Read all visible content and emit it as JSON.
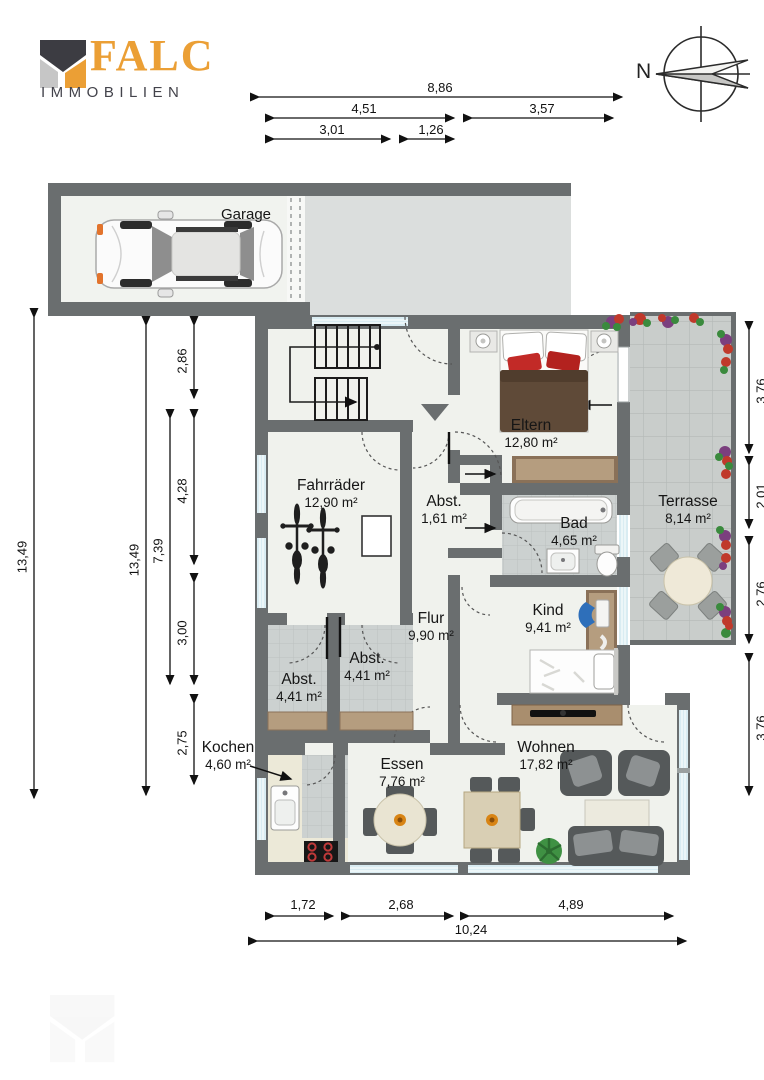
{
  "brand": {
    "name": "FALC",
    "sub": "IMMOBILIEN"
  },
  "compass": {
    "label": "N"
  },
  "rooms": [
    {
      "id": "garage",
      "name": "Garage",
      "area": ""
    },
    {
      "id": "eltern",
      "name": "Eltern",
      "area": "12,80 m²"
    },
    {
      "id": "fahrraeder",
      "name": "Fahrräder",
      "area": "12,90 m²"
    },
    {
      "id": "abst-klein",
      "name": "Abst.",
      "area": "1,61 m²"
    },
    {
      "id": "bad",
      "name": "Bad",
      "area": "4,65 m²"
    },
    {
      "id": "terrasse",
      "name": "Terrasse",
      "area": "8,14 m²"
    },
    {
      "id": "flur",
      "name": "Flur",
      "area": "9,90 m²"
    },
    {
      "id": "kind",
      "name": "Kind",
      "area": "9,41 m²"
    },
    {
      "id": "abst-links",
      "name": "Abst.",
      "area": "4,41 m²"
    },
    {
      "id": "abst-rechts",
      "name": "Abst.",
      "area": "4,41 m²"
    },
    {
      "id": "kochen",
      "name": "Kochen",
      "area": "4,60 m²"
    },
    {
      "id": "essen",
      "name": "Essen",
      "area": "7,76 m²"
    },
    {
      "id": "wohnen",
      "name": "Wohnen",
      "area": "17,82 m²"
    }
  ],
  "dimensions": {
    "top": [
      "8,86",
      "4,51",
      "3,57",
      "3,01",
      "1,26"
    ],
    "bottom": [
      "1,72",
      "2,68",
      "4,89",
      "10,24"
    ],
    "left": [
      "13,49",
      "13,49",
      "7,39",
      "2,86",
      "4,28",
      "3,00",
      "2,75"
    ],
    "right": [
      "3,76",
      "2,01",
      "2,76",
      "3,76"
    ]
  },
  "colors": {
    "wall": "#6a6e6f",
    "floor": "#f0f2ed",
    "tile": "#ccd1d0",
    "terrace": "#c9cdcb",
    "driveway": "#dbdedd",
    "window": "#d9ecf2",
    "wood_dark": "#8a7158",
    "wood_light": "#b59d7f",
    "furniture_dark": "#55595a",
    "brand_orange": "#eb9f35",
    "brand_gray": "#43434b"
  }
}
